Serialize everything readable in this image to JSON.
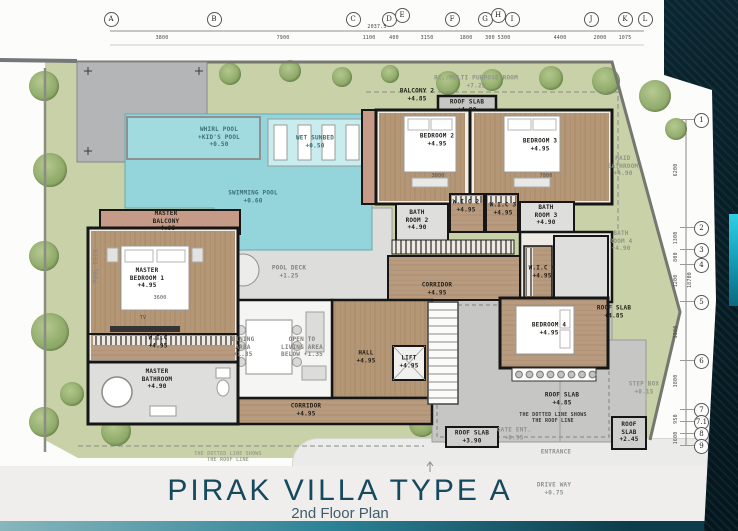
{
  "title": {
    "main": "PIRAK VILLA TYPE  A",
    "sub": "2nd Floor Plan"
  },
  "grid": {
    "columns": [
      {
        "l": "A",
        "x": 110,
        "y": 18
      },
      {
        "l": "B",
        "x": 213,
        "y": 18
      },
      {
        "l": "C",
        "x": 352,
        "y": 18
      },
      {
        "l": "D",
        "x": 388,
        "y": 18
      },
      {
        "l": "E",
        "x": 401,
        "y": 14
      },
      {
        "l": "F",
        "x": 451,
        "y": 18
      },
      {
        "l": "G",
        "x": 484,
        "y": 18
      },
      {
        "l": "H",
        "x": 497,
        "y": 14
      },
      {
        "l": "I",
        "x": 511,
        "y": 18
      },
      {
        "l": "J",
        "x": 590,
        "y": 18
      },
      {
        "l": "K",
        "x": 624,
        "y": 18
      },
      {
        "l": "L",
        "x": 644,
        "y": 18
      }
    ],
    "top_dims": [
      {
        "v": "3800",
        "x": 162
      },
      {
        "v": "7900",
        "x": 283
      },
      {
        "v": "1100",
        "x": 369
      },
      {
        "v": "400",
        "x": 394
      },
      {
        "v": "3150",
        "x": 427
      },
      {
        "v": "1800",
        "x": 466
      },
      {
        "v": "300",
        "x": 490
      },
      {
        "v": "5300",
        "x": 504
      },
      {
        "v": "4400",
        "x": 560
      },
      {
        "v": "2000",
        "x": 600
      },
      {
        "v": "1075",
        "x": 625
      },
      {
        "v": "2037.5",
        "x": 377,
        "y": 27
      }
    ],
    "rows": [
      {
        "l": "1",
        "y": 119
      },
      {
        "l": "2",
        "y": 227
      },
      {
        "l": "3",
        "y": 249
      },
      {
        "l": "4",
        "y": 264
      },
      {
        "l": "5",
        "y": 301
      },
      {
        "l": "6",
        "y": 360
      },
      {
        "l": "7",
        "y": 409
      },
      {
        "l": "7.1",
        "y": 421
      },
      {
        "l": "8",
        "y": 433
      },
      {
        "l": "9",
        "y": 445
      }
    ],
    "right_dims": [
      {
        "v": "6200",
        "y": 170
      },
      {
        "v": "1300",
        "y": 238
      },
      {
        "v": "800",
        "y": 257
      },
      {
        "v": "1200",
        "y": 281
      },
      {
        "v": "18700",
        "y": 280,
        "x": 690
      },
      {
        "v": "3300",
        "y": 332
      },
      {
        "v": "3800",
        "y": 381
      },
      {
        "v": "950",
        "y": 419
      },
      {
        "v": "1600",
        "y": 438
      }
    ]
  },
  "labels": [
    {
      "t": "RC./MULTI PURPOSE ROOM\n+7.25",
      "x": 476,
      "y": 82,
      "c": "ghost"
    },
    {
      "t": "BALCONY 2\n+4.85",
      "x": 417,
      "y": 95,
      "c": "plan"
    },
    {
      "t": "ROOF SLAB\n+4.90",
      "x": 467,
      "y": 106,
      "c": "plan"
    },
    {
      "t": "WHIRL POOL\n+KID'S POOL\n+0.50",
      "x": 219,
      "y": 137,
      "c": "pool"
    },
    {
      "t": "WET SUNBED\n+0.50",
      "x": 315,
      "y": 142,
      "c": "pool"
    },
    {
      "t": "SWIMMING POOL\n+0.60",
      "x": 253,
      "y": 197,
      "c": "pool"
    },
    {
      "t": "BEDROOM 2\n+4.95",
      "x": 437,
      "y": 140,
      "c": "plan"
    },
    {
      "t": "BEDROOM 3\n+4.95",
      "x": 540,
      "y": 145,
      "c": "plan"
    },
    {
      "t": "MAID\nBATHROOM\n+4.90",
      "x": 623,
      "y": 166,
      "c": "ghost"
    },
    {
      "t": "BATH\nROOM 2\n+4.90",
      "x": 417,
      "y": 220,
      "c": "plan"
    },
    {
      "t": "W.I.C 2\n+4.95",
      "x": 466,
      "y": 206,
      "c": "plan"
    },
    {
      "t": "W.I.C 3\n+4.95",
      "x": 503,
      "y": 209,
      "c": "plan"
    },
    {
      "t": "BATH\nROOM 3\n+4.90",
      "x": 546,
      "y": 215,
      "c": "plan"
    },
    {
      "t": "BATH\nROOM 4\n+4.90",
      "x": 621,
      "y": 241,
      "c": "ghost"
    },
    {
      "t": "W.I.C 4\n+4.95",
      "x": 542,
      "y": 272,
      "c": "plan"
    },
    {
      "t": "MASTER\nBALCONY\n+4.95",
      "x": 166,
      "y": 221,
      "c": "plan"
    },
    {
      "t": "MASTER\nBEDROOM 1\n+4.95",
      "x": 147,
      "y": 278,
      "c": "plan"
    },
    {
      "t": "POOL DECK\n+1.25",
      "x": 289,
      "y": 272,
      "c": "deck"
    },
    {
      "t": "CORRIDOR\n+4.95",
      "x": 437,
      "y": 289,
      "c": "plan"
    },
    {
      "t": "ROOF SLAB\n+4.85",
      "x": 614,
      "y": 312,
      "c": "plan"
    },
    {
      "t": "W.I.C\n+4.95",
      "x": 158,
      "y": 342,
      "c": "plan"
    },
    {
      "t": "TV",
      "x": 143,
      "y": 318,
      "c": "dimin"
    },
    {
      "t": "DINING\nAREA\n+1.35",
      "x": 243,
      "y": 347,
      "c": "deck"
    },
    {
      "t": "OPEN TO\nLIVING AREA\nBELOW +1.35",
      "x": 302,
      "y": 347,
      "c": "deck"
    },
    {
      "t": "HALL\n+4.95",
      "x": 366,
      "y": 357,
      "c": "plan"
    },
    {
      "t": "LIFT\n+4.95",
      "x": 409,
      "y": 362,
      "c": "plan"
    },
    {
      "t": "BEDROOM 4\n+4.95",
      "x": 549,
      "y": 329,
      "c": "plan"
    },
    {
      "t": "MASTER\nBATHROOM\n+4.90",
      "x": 157,
      "y": 379,
      "c": "plan"
    },
    {
      "t": "CORRIDOR\n+4.95",
      "x": 306,
      "y": 410,
      "c": "plan"
    },
    {
      "t": "ROOF SLAB\n+4.85",
      "x": 562,
      "y": 399,
      "c": "plan"
    },
    {
      "t": "STEP BOX\n+0.15",
      "x": 644,
      "y": 388,
      "c": "ghost"
    },
    {
      "t": "THE DOTTED LINE SHOWS\nTHE ROOF LINE",
      "x": 553,
      "y": 418,
      "c": "note"
    },
    {
      "t": "ROOF SLAB\n+3.90",
      "x": 472,
      "y": 437,
      "c": "plan"
    },
    {
      "t": "GATE ENT.\n+0.95",
      "x": 514,
      "y": 434,
      "c": "ghost"
    },
    {
      "t": "ROOF\nSLAB\n+2.45",
      "x": 629,
      "y": 432,
      "c": "plan"
    },
    {
      "t": "ENTRANCE",
      "x": 556,
      "y": 452,
      "c": "ghost"
    },
    {
      "t": "THE DOTTED LINE SHOWS\nTHE ROOF LINE",
      "x": 228,
      "y": 457,
      "c": "ghost-note"
    },
    {
      "t": "DRIVE WAY\n+0.75",
      "x": 554,
      "y": 489,
      "c": "ghost"
    },
    {
      "t": "POOL DECK",
      "x": 96,
      "y": 266,
      "c": "vert"
    },
    {
      "t": "3600",
      "x": 160,
      "y": 298,
      "c": "dimin"
    },
    {
      "t": "3000",
      "x": 438,
      "y": 176,
      "c": "dimin"
    },
    {
      "t": "7000",
      "x": 546,
      "y": 176,
      "c": "dimin"
    }
  ],
  "trees": [
    {
      "x": 44,
      "y": 86,
      "r": 15
    },
    {
      "x": 50,
      "y": 170,
      "r": 17
    },
    {
      "x": 44,
      "y": 256,
      "r": 15
    },
    {
      "x": 50,
      "y": 332,
      "r": 19
    },
    {
      "x": 44,
      "y": 422,
      "r": 15
    },
    {
      "x": 72,
      "y": 394,
      "r": 12
    },
    {
      "x": 116,
      "y": 431,
      "r": 15
    },
    {
      "x": 230,
      "y": 74,
      "r": 11
    },
    {
      "x": 290,
      "y": 71,
      "r": 11
    },
    {
      "x": 342,
      "y": 77,
      "r": 10
    },
    {
      "x": 390,
      "y": 74,
      "r": 9
    },
    {
      "x": 448,
      "y": 83,
      "r": 12
    },
    {
      "x": 492,
      "y": 80,
      "r": 11
    },
    {
      "x": 551,
      "y": 78,
      "r": 12
    },
    {
      "x": 606,
      "y": 81,
      "r": 14
    },
    {
      "x": 655,
      "y": 96,
      "r": 16
    },
    {
      "x": 676,
      "y": 129,
      "r": 11
    },
    {
      "x": 422,
      "y": 424,
      "r": 13
    }
  ],
  "colors": {
    "accent_teal": "#1cc2da",
    "title_text": "#17495e",
    "subtitle_text": "#3f5d6b",
    "site_green": "#c8d1a7",
    "pool_water": "#93d5da",
    "wood_floor": "#b89b7f",
    "roof_slab_gray": "#c6c7c5",
    "wall_black": "#161616",
    "dark_panel": "#0b2a35"
  }
}
